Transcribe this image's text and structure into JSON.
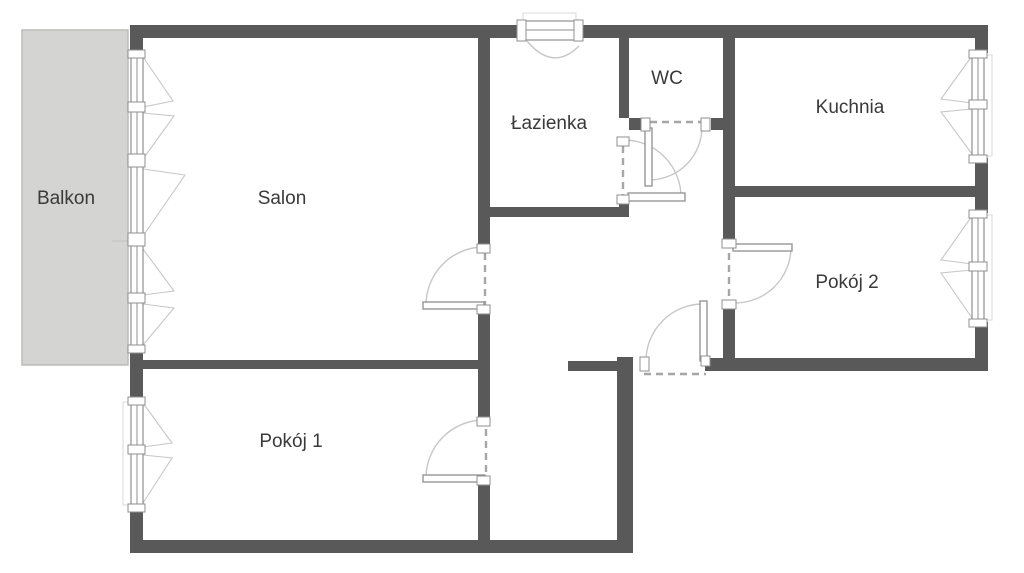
{
  "plan": {
    "type": "apartment-floorplan",
    "rooms": {
      "balkon": {
        "label": "Balkon"
      },
      "salon": {
        "label": "Salon"
      },
      "lazienka": {
        "label": "Łazienka"
      },
      "wc": {
        "label": "WC"
      },
      "kuchnia": {
        "label": "Kuchnia"
      },
      "pokoj1": {
        "label": "Pokój 1"
      },
      "pokoj2": {
        "label": "Pokój 2"
      }
    }
  },
  "colors": {
    "bg": "#ffffff",
    "wall": "#595959",
    "balcony": "#d4d4d2",
    "balconyBorder": "#bcbcba",
    "frame": "#8f8f8f",
    "arc": "#c7c7c7",
    "dash": "#a6a6a6",
    "label": "#3a3a3a"
  }
}
